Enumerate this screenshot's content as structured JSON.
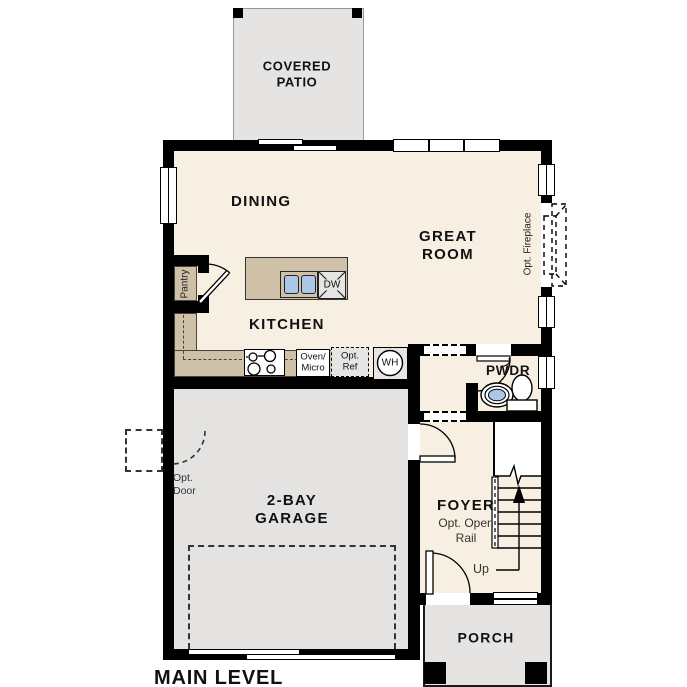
{
  "plan_title": "MAIN LEVEL",
  "colors": {
    "wall": "#000000",
    "floor": "#f7efe2",
    "garage": "#e4e3e1",
    "outdoor": "#e5e4e2",
    "counter": "#cfc0a8",
    "fixture_blue": "#aac7e6",
    "appliance_gray": "#e6e5e3"
  },
  "rooms": {
    "covered_patio": "COVERED\nPATIO",
    "dining": "DINING",
    "great_room": "GREAT\nROOM",
    "kitchen": "KITCHEN",
    "pantry": "Pantry",
    "garage": "2-BAY\nGARAGE",
    "foyer": "FOYER",
    "pwdr": "PWDR",
    "porch": "PORCH"
  },
  "annotations": {
    "opt_fireplace": "Opt. Fireplace",
    "opt_door": "Opt.\nDoor",
    "opt_open_rail": "Opt. Open\nRail",
    "up": "Up"
  },
  "fixtures": {
    "oven_micro": "Oven/\nMicro",
    "opt_ref": "Opt.\nRef",
    "dishwasher": "DW",
    "water_heater": "WH"
  }
}
